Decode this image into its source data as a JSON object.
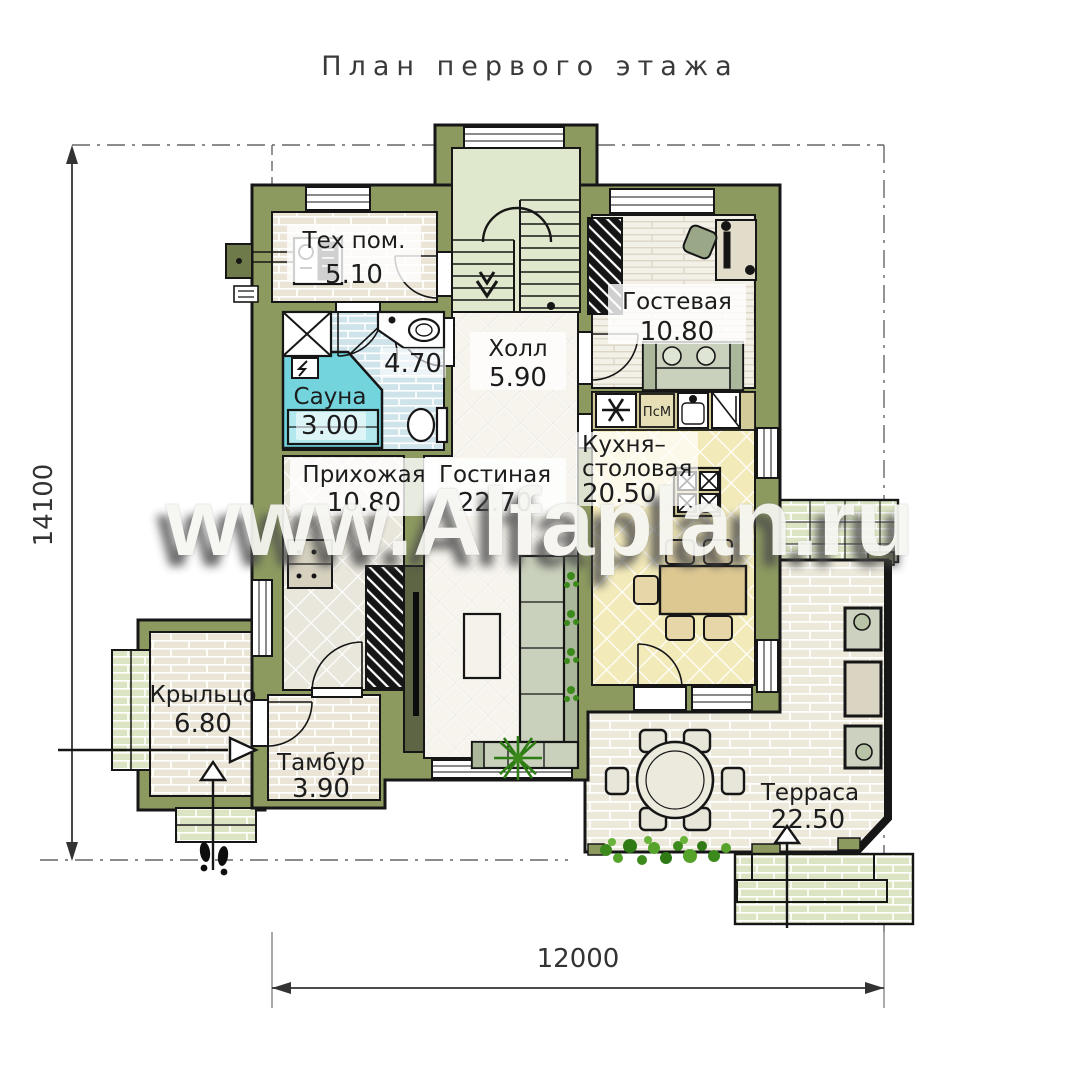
{
  "title": "План  первого  этажа",
  "watermark": "www.Alfaplan.ru",
  "dimensions": {
    "height_mm": "14100",
    "width_mm": "12000"
  },
  "rooms": {
    "tech": {
      "name": "Тех пом.",
      "area": "5.10"
    },
    "guest": {
      "name": "Гостевая",
      "area": "10.80"
    },
    "hall": {
      "name": "Холл",
      "area": "5.90"
    },
    "bath": {
      "area": "4.70"
    },
    "sauna": {
      "name": "Сауна",
      "area": "3.00"
    },
    "entry": {
      "name": "Прихожая",
      "area": "10.80"
    },
    "living": {
      "name": "Гостиная",
      "area": "22.70"
    },
    "kitchen": {
      "name_line1": "Кухня–",
      "name_line2": "столовая",
      "area": "20.50"
    },
    "porch": {
      "name": "Крыльцо",
      "area": "6.80"
    },
    "vestibule": {
      "name": "Тамбур",
      "area": "3.90"
    },
    "terrace": {
      "name": "Терраса",
      "area": "22.50"
    }
  },
  "annotations": {
    "dishwasher": "ПсМ"
  },
  "colors": {
    "wall_olive": "#8c9a60",
    "outline": "#161616",
    "floor_beige": "#eae5d6",
    "floor_plank": "#f3f0e7",
    "floor_blue": "#cfe4ea",
    "floor_yellow": "#f3eaba",
    "floor_white_tile": "#f6f4ed",
    "floor_gray_tile": "#e9e6dc",
    "sauna_cyan": "#74d4de",
    "stair_green": "#dfe8cd",
    "paver_green": "#dbe5c3",
    "counter_khaki": "#d2ca98",
    "table_tan": "#ddc892",
    "sofa_green": "#c9d0bb",
    "plant_green": "#3c8a1c"
  }
}
